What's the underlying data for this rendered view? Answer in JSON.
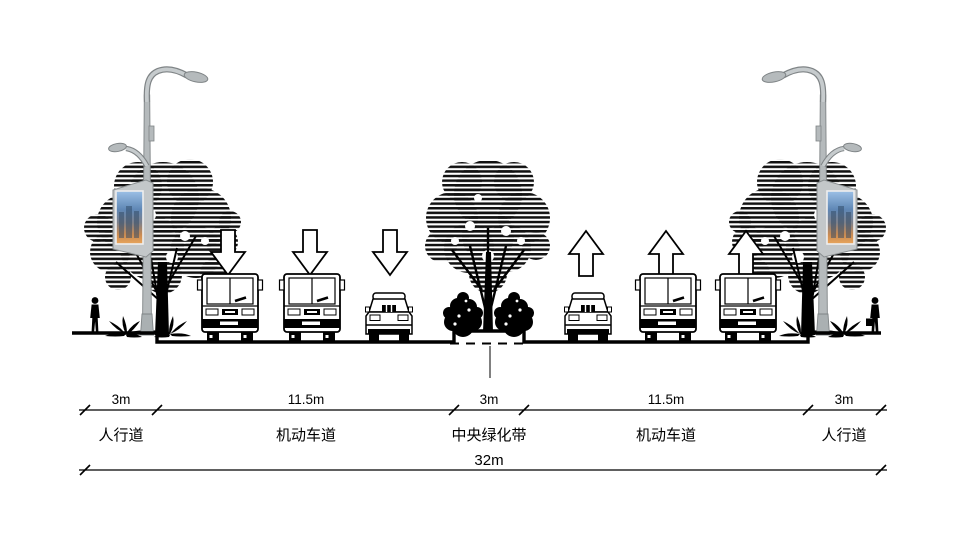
{
  "diagram": {
    "type": "road-cross-section",
    "total": {
      "width_label": "32m"
    },
    "segments": [
      {
        "width_label": "3m",
        "name": "人行道"
      },
      {
        "width_label": "11.5m",
        "name": "机动车道"
      },
      {
        "width_label": "3m",
        "name": "中央绿化带"
      },
      {
        "width_label": "11.5m",
        "name": "机动车道"
      },
      {
        "width_label": "3m",
        "name": "人行道"
      }
    ],
    "lanes": {
      "left_carriageway": {
        "direction_arrows": "down",
        "vehicles": [
          "bus",
          "bus",
          "car"
        ]
      },
      "right_carriageway": {
        "direction_arrows": "up",
        "vehicles": [
          "car",
          "bus",
          "bus"
        ]
      }
    },
    "streetside_features": [
      "smart-lamp-pole-with-display-screen",
      "street-tree",
      "pedestrian",
      "ground-plants"
    ],
    "median_features": [
      "tree",
      "shrubs",
      "raised-planter"
    ],
    "colors": {
      "ink": "#000000",
      "pole": "#b5babc",
      "pole_outline": "#7f8486",
      "screen_sky": "#8fb6e0",
      "screen_glow": "#d8874a",
      "background": "#ffffff"
    }
  }
}
